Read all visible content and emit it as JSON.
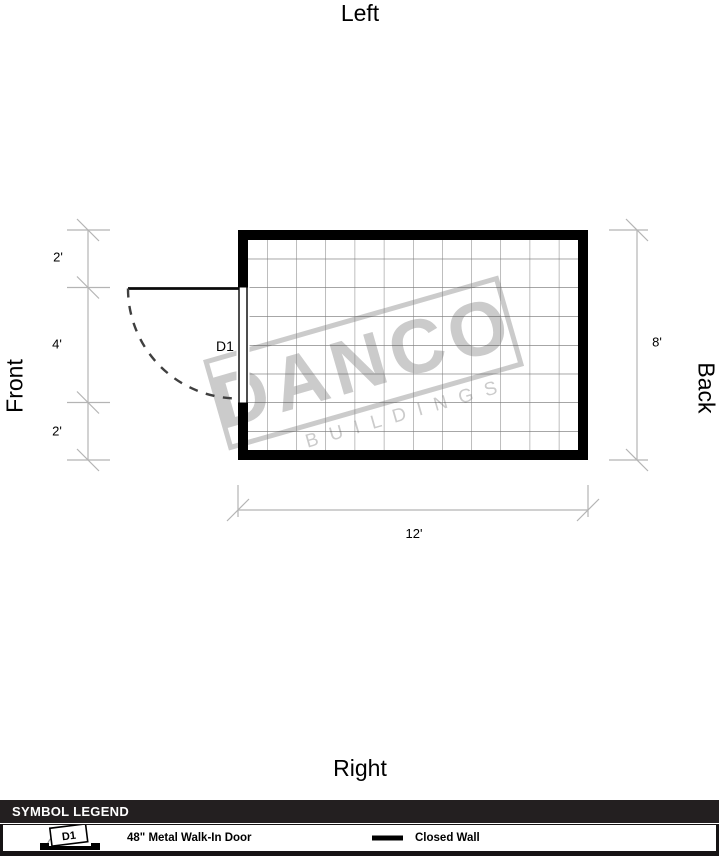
{
  "orientation": {
    "top": "Left",
    "bottom": "Right",
    "left": "Front",
    "right": "Back"
  },
  "plan": {
    "door_label": "D1",
    "dims": {
      "left_top": "2'",
      "left_mid": "4'",
      "left_bottom": "2'",
      "right": "8'",
      "bottom": "12'"
    }
  },
  "watermark": {
    "name": "DANCO",
    "tagline": "BUILDINGS"
  },
  "legend": {
    "header": "SYMBOL LEGEND",
    "door_item": {
      "symbol_label": "D1",
      "label": "48\" Metal Walk-In Door"
    },
    "wall_item": {
      "label": "Closed Wall"
    }
  },
  "colors": {
    "wall": "#000000",
    "grid_line": "#5f5f5f",
    "dimension_line": "#b4b4b4",
    "watermark": "#cbcbcb",
    "legend_header_bg": "#231f20"
  }
}
